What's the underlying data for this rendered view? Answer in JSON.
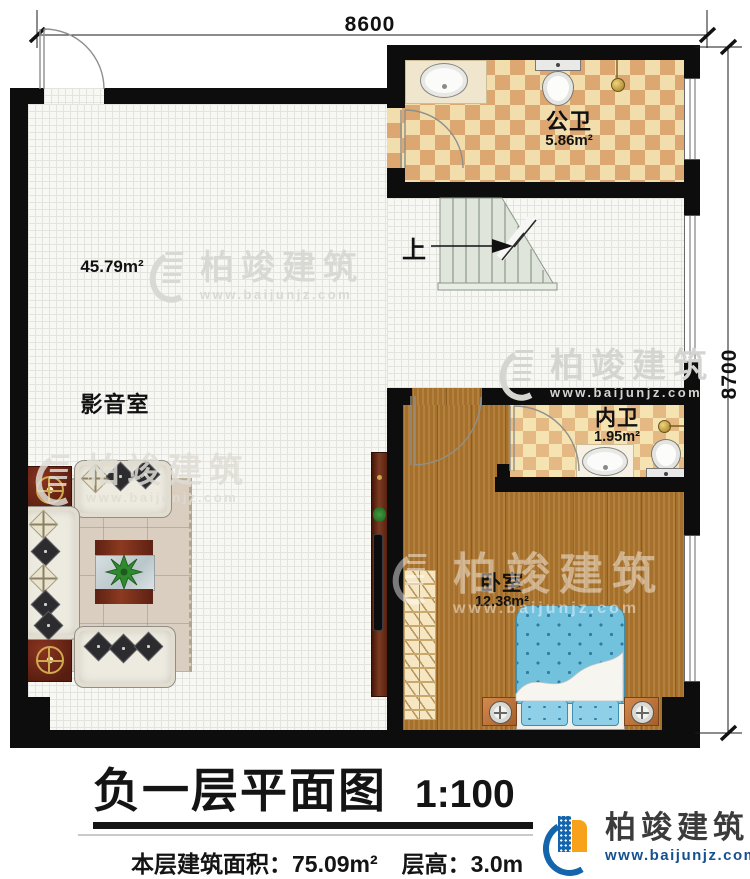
{
  "dimensions": {
    "top": "8600",
    "right": "8700"
  },
  "rooms": {
    "gongwei": {
      "name": "公卫",
      "area": "5.86m²"
    },
    "yingyinshi": {
      "name": "影音室",
      "area": "45.79m²"
    },
    "neiwei": {
      "name": "内卫",
      "area": "1.95m²"
    },
    "woshi": {
      "name": "卧室",
      "area": "12.38m²"
    }
  },
  "stairs": {
    "up_label": "上"
  },
  "title_block": {
    "title": "负一层平面图",
    "scale": "1:100",
    "area_label": "本层建筑面积：",
    "area_value": "75.09m²",
    "height_label": "层高：",
    "height_value": "3.0m"
  },
  "brand": {
    "name": "柏竣建筑",
    "url": "www.baijunjz.com"
  },
  "colors": {
    "wall": "#0d0d0d",
    "wood_floor": "#ad7730",
    "checker_dark": "#dca770",
    "checker_light": "#f2ddad",
    "bed_blue": "#72c2de",
    "stair_green": "#dfe5da",
    "brand_blue": "#1565ad",
    "brand_orange": "#f7a21a"
  }
}
